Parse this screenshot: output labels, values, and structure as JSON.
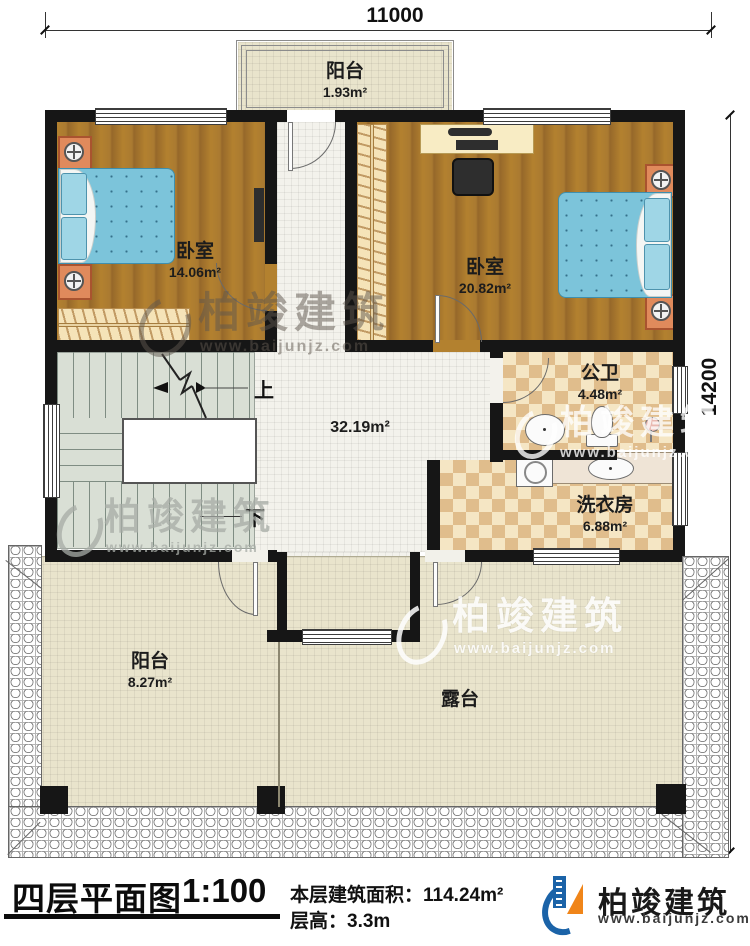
{
  "dimensions": {
    "width_mm": "11000",
    "height_mm": "14200"
  },
  "rooms": {
    "balcony_top": {
      "name": "阳台",
      "area": "1.93m²"
    },
    "bedroom_left": {
      "name": "卧室",
      "area": "14.06m²"
    },
    "bedroom_right": {
      "name": "卧室",
      "area": "20.82m²"
    },
    "hall": {
      "area": "32.19m²"
    },
    "bathroom": {
      "name": "公卫",
      "area": "4.48m²"
    },
    "laundry": {
      "name": "洗衣房",
      "area": "6.88m²"
    },
    "balcony_bottom": {
      "name": "阳台",
      "area": "8.27m²"
    },
    "terrace": {
      "name": "露台"
    }
  },
  "stairs": {
    "up": "上",
    "down": "下"
  },
  "title_block": {
    "title": "四层平面图",
    "scale": "1:100",
    "area_label": "本层建筑面积：",
    "area_value": "114.24m²",
    "height_label": "层高：",
    "height_value": "3.3m"
  },
  "brand": {
    "name": "柏竣建筑",
    "website": "www.baijunjz.com"
  },
  "watermark": {
    "name": "柏竣建筑",
    "website": "www.baijunjz.com"
  },
  "colors": {
    "wall": "#161616",
    "wood": "#a97a30",
    "bed_blue": "#7cc4da",
    "checker": "#e0bd8c",
    "accent_blue": "#1b63a8",
    "accent_orange": "#f08519"
  }
}
